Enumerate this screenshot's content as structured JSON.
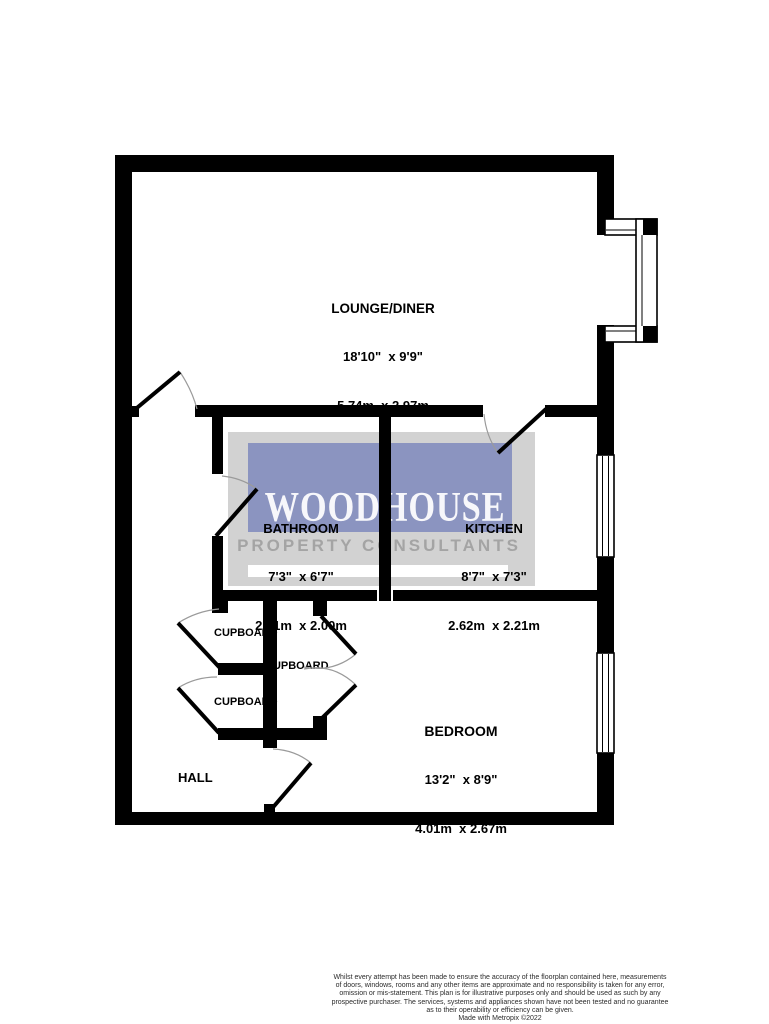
{
  "watermark": {
    "brand": "WOODHOUSE",
    "tagline": "PROPERTY CONSULTANTS"
  },
  "rooms": {
    "lounge": {
      "name": "LOUNGE/DINER",
      "imperial": "18'10\"  x 9'9\"",
      "metric": "5.74m  x 2.97m"
    },
    "bathroom": {
      "name": "BATHROOM",
      "imperial": "7'3\"  x 6'7\"",
      "metric": "2.21m  x 2.00m"
    },
    "kitchen": {
      "name": "KITCHEN",
      "imperial": "8'7\"  x 7'3\"",
      "metric": "2.62m  x 2.21m"
    },
    "bedroom": {
      "name": "BEDROOM",
      "imperial": "13'2\"  x 8'9\"",
      "metric": "4.01m  x 2.67m"
    },
    "hall": {
      "name": "HALL"
    },
    "cupboard_top": {
      "name": "CUPBOARD"
    },
    "cupboard_middle": {
      "name": "CUPBOARD"
    },
    "cupboard_bottom": {
      "name": "CUPBOARD"
    }
  },
  "footer": {
    "lines": [
      "Whilst every attempt has been made to ensure the accuracy of the floorplan contained here, measurements",
      "of doors, windows, rooms and any other items are approximate and no responsibility is taken for any error,",
      "omission or mis-statement. This plan is for illustrative purposes only and should be used as such by any",
      "prospective purchaser. The services, systems and appliances shown have not been tested and no guarantee",
      "as to their operability or efficiency can be given.",
      "Made with Metropix ©2022"
    ]
  },
  "colors": {
    "wall": "#000000",
    "background": "#ffffff",
    "watermark_panel": "#d2d2d2",
    "watermark_blue": "#8b94c0",
    "watermark_brand_text": "#ffffff",
    "watermark_tagline_text": "#a4a4a4",
    "label_text": "#000000",
    "door_arc": "#9a9a9a",
    "footer_text": "#2b2b2b"
  }
}
